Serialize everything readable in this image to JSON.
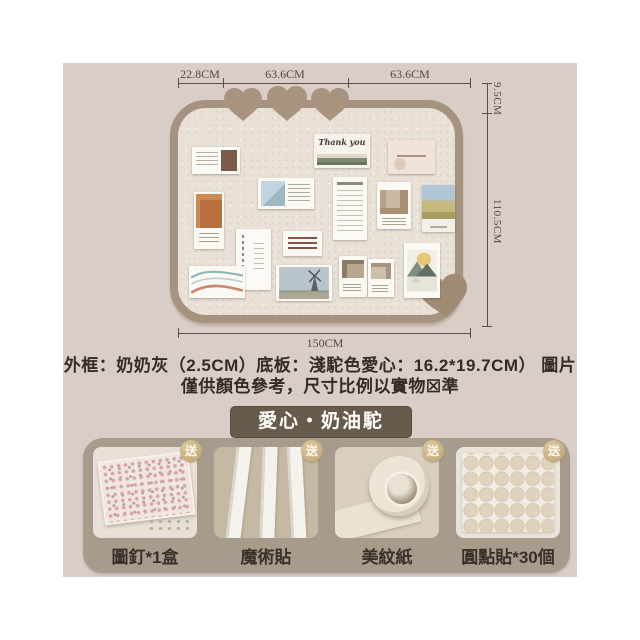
{
  "diagram": {
    "dimensions": {
      "top": [
        "22.8CM",
        "63.6CM",
        "63.6CM"
      ],
      "right": [
        "9.5CM",
        "110.5CM"
      ],
      "bottom": "150CM"
    },
    "card_text": {
      "thank_you": "Thank you"
    }
  },
  "description": {
    "line1": "外框：奶奶灰（2.5CM）底板：淺駝色愛心：16.2*19.7CM） 圖片",
    "line2": "僅供顏色參考，尺寸比例以實物☒準"
  },
  "variant_badge": {
    "label": "愛心・奶油駝"
  },
  "products": {
    "gift_badge": "送",
    "items": [
      {
        "label": "圖釘*1盒"
      },
      {
        "label": "魔術貼"
      },
      {
        "label": "美紋紙"
      },
      {
        "label": "圓點貼*30個"
      }
    ]
  },
  "colors": {
    "content_background": "#d9cdc8",
    "board_frame": "#a6937f",
    "board_surface": "#e9e1d7",
    "heart": "#a8937e",
    "dimension_text": "#53493f",
    "variant_badge_bg": "#695b4b",
    "panel_bg": "#a79b8c",
    "gift_badge_gold": "#c3a876",
    "label_text": "#39302a"
  }
}
